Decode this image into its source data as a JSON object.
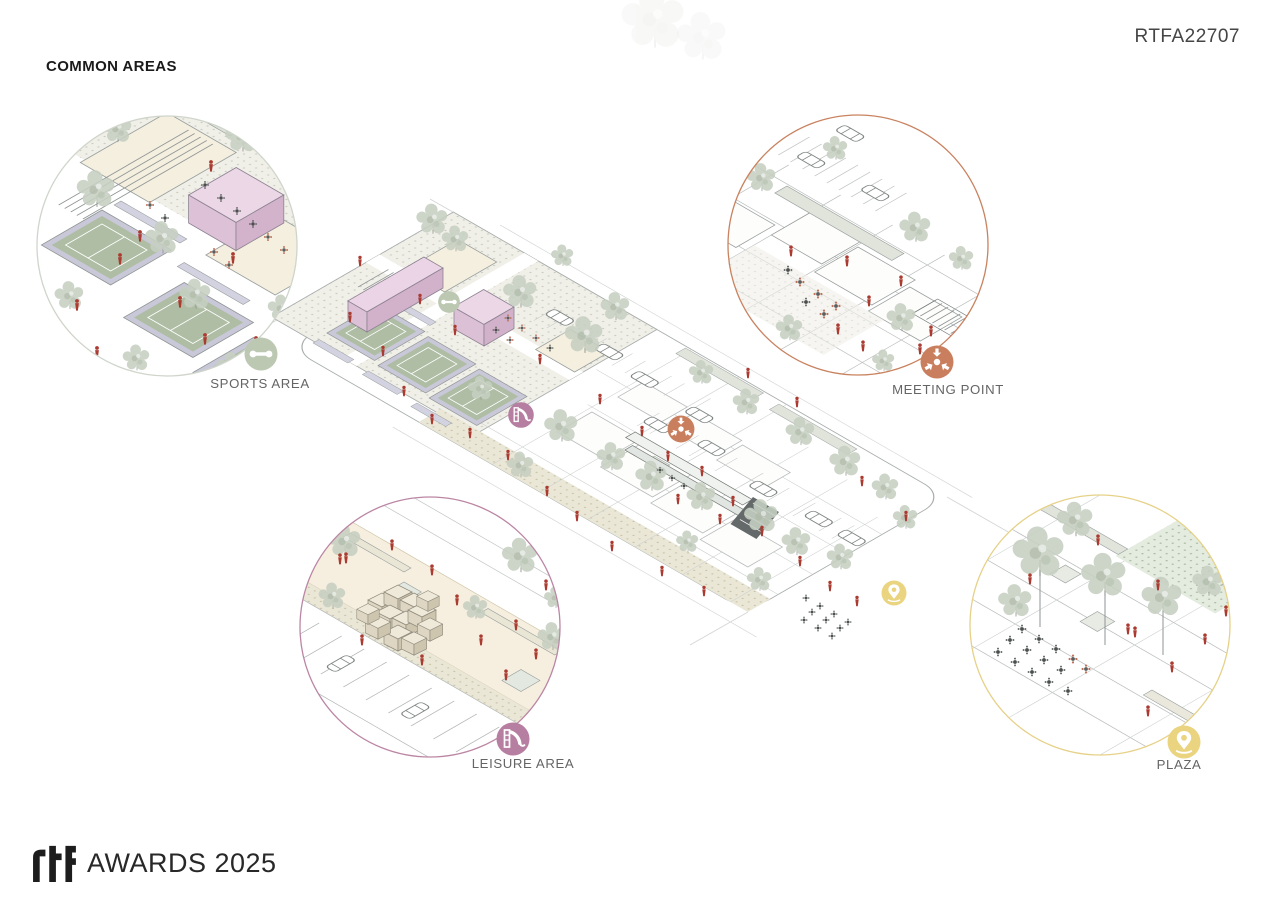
{
  "header": {
    "title": "COMMON AREAS",
    "project_code": "RTFA22707"
  },
  "footer": {
    "brand": "rtf",
    "award_text": "AWARDS 2025"
  },
  "areas": [
    {
      "id": "sports",
      "label": "SPORTS AREA",
      "icon": "dumbbell-icon",
      "color": "#bcc8b2",
      "ring_color": "#cfd5cb"
    },
    {
      "id": "meeting",
      "label": "MEETING POINT",
      "icon": "converge-arrows-icon",
      "color": "#c97f5e",
      "ring_color": "#c9825f"
    },
    {
      "id": "leisure",
      "label": "LEISURE AREA",
      "icon": "playground-slide-icon",
      "color": "#b67ea0",
      "ring_color": "#bb86a4"
    },
    {
      "id": "plaza",
      "label": "PLAZA",
      "icon": "location-pin-icon",
      "color": "#ead480",
      "ring_color": "#e6d188"
    }
  ],
  "palette": {
    "people_red": "#ab3a30",
    "building_pink": "#e9d2e3",
    "court_green": "#aebda3",
    "court_border": "#c9c8d8",
    "sand": "#f5efdf",
    "tree_sage": "#c6cfc2",
    "line_gray": "#a8adac",
    "background": "#ffffff"
  }
}
